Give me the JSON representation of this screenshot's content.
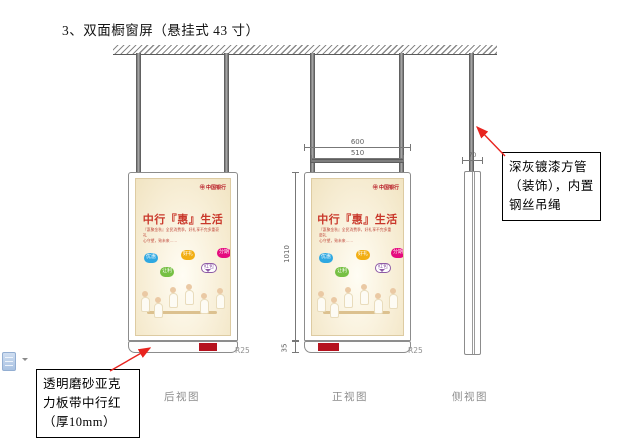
{
  "page": {
    "title": "3、双面橱窗屏（悬挂式 43 寸）"
  },
  "drawing": {
    "views": [
      {
        "id": "rear",
        "label": "后视图",
        "corner_radius": "R25"
      },
      {
        "id": "front",
        "label": "正视图",
        "corner_radius": "R25"
      },
      {
        "id": "side",
        "label": "侧视图"
      }
    ],
    "dimensions": {
      "outer_width": "600",
      "inner_width": "510",
      "screen_height": "1010",
      "base_height": "35",
      "side_depth": "70"
    }
  },
  "callouts": {
    "pipe_note": {
      "text": "深灰镀漆方管（装饰），内置钢丝吊绳"
    },
    "acrylic_note": {
      "text": "透明磨砂亚克力板带中行红（厚10mm）"
    }
  },
  "ad": {
    "logo_text": "㊥ 中国银行",
    "headline": "中行『惠』生活",
    "subtext_line1": "『惠聚金秋』全民消费季，好礼享不完多重豪礼",
    "subtext_line2": "心守望，致未来……",
    "bubbles": [
      {
        "label": "优惠",
        "color": "#2fa8e1"
      },
      {
        "label": "让利",
        "color": "#76c043"
      },
      {
        "label": "好礼",
        "color": "#f2ae13"
      },
      {
        "label": "红包",
        "color": "#8e5ba6"
      },
      {
        "label": "分期",
        "color": "#e50b7e"
      }
    ]
  },
  "colors": {
    "boc_red": "#b5121e",
    "arrow_red": "#e8241f",
    "pole_gray": "#8d8d8d",
    "dim_gray": "#5f5f5f",
    "poster_cream": "#f7eed6"
  }
}
